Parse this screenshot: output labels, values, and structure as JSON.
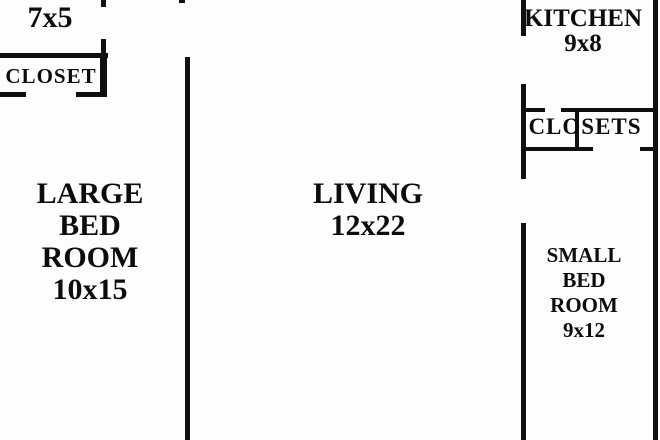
{
  "title": "Apartment floor plan",
  "colors": {
    "background": "#fdfdfd",
    "wall": "#101010",
    "text": "#0c0c0c"
  },
  "rooms": {
    "bathroom": {
      "lines": [
        "7x5"
      ],
      "size": "7x5"
    },
    "closet": {
      "lines": [
        "CLOSET"
      ]
    },
    "large_bedroom": {
      "lines": [
        "LARGE",
        "BED",
        "ROOM",
        "10x15"
      ],
      "size": "10x15"
    },
    "living": {
      "lines": [
        "LIVING",
        "12x22"
      ],
      "size": "12x22"
    },
    "kitchen": {
      "lines": [
        "KITCHEN",
        "9x8"
      ],
      "size": "9x8"
    },
    "closets": {
      "lines": [
        "CLOSETS"
      ]
    },
    "small_bedroom": {
      "lines": [
        "SMALL",
        "BED",
        "ROOM",
        "9x12"
      ],
      "size": "9x12"
    }
  }
}
